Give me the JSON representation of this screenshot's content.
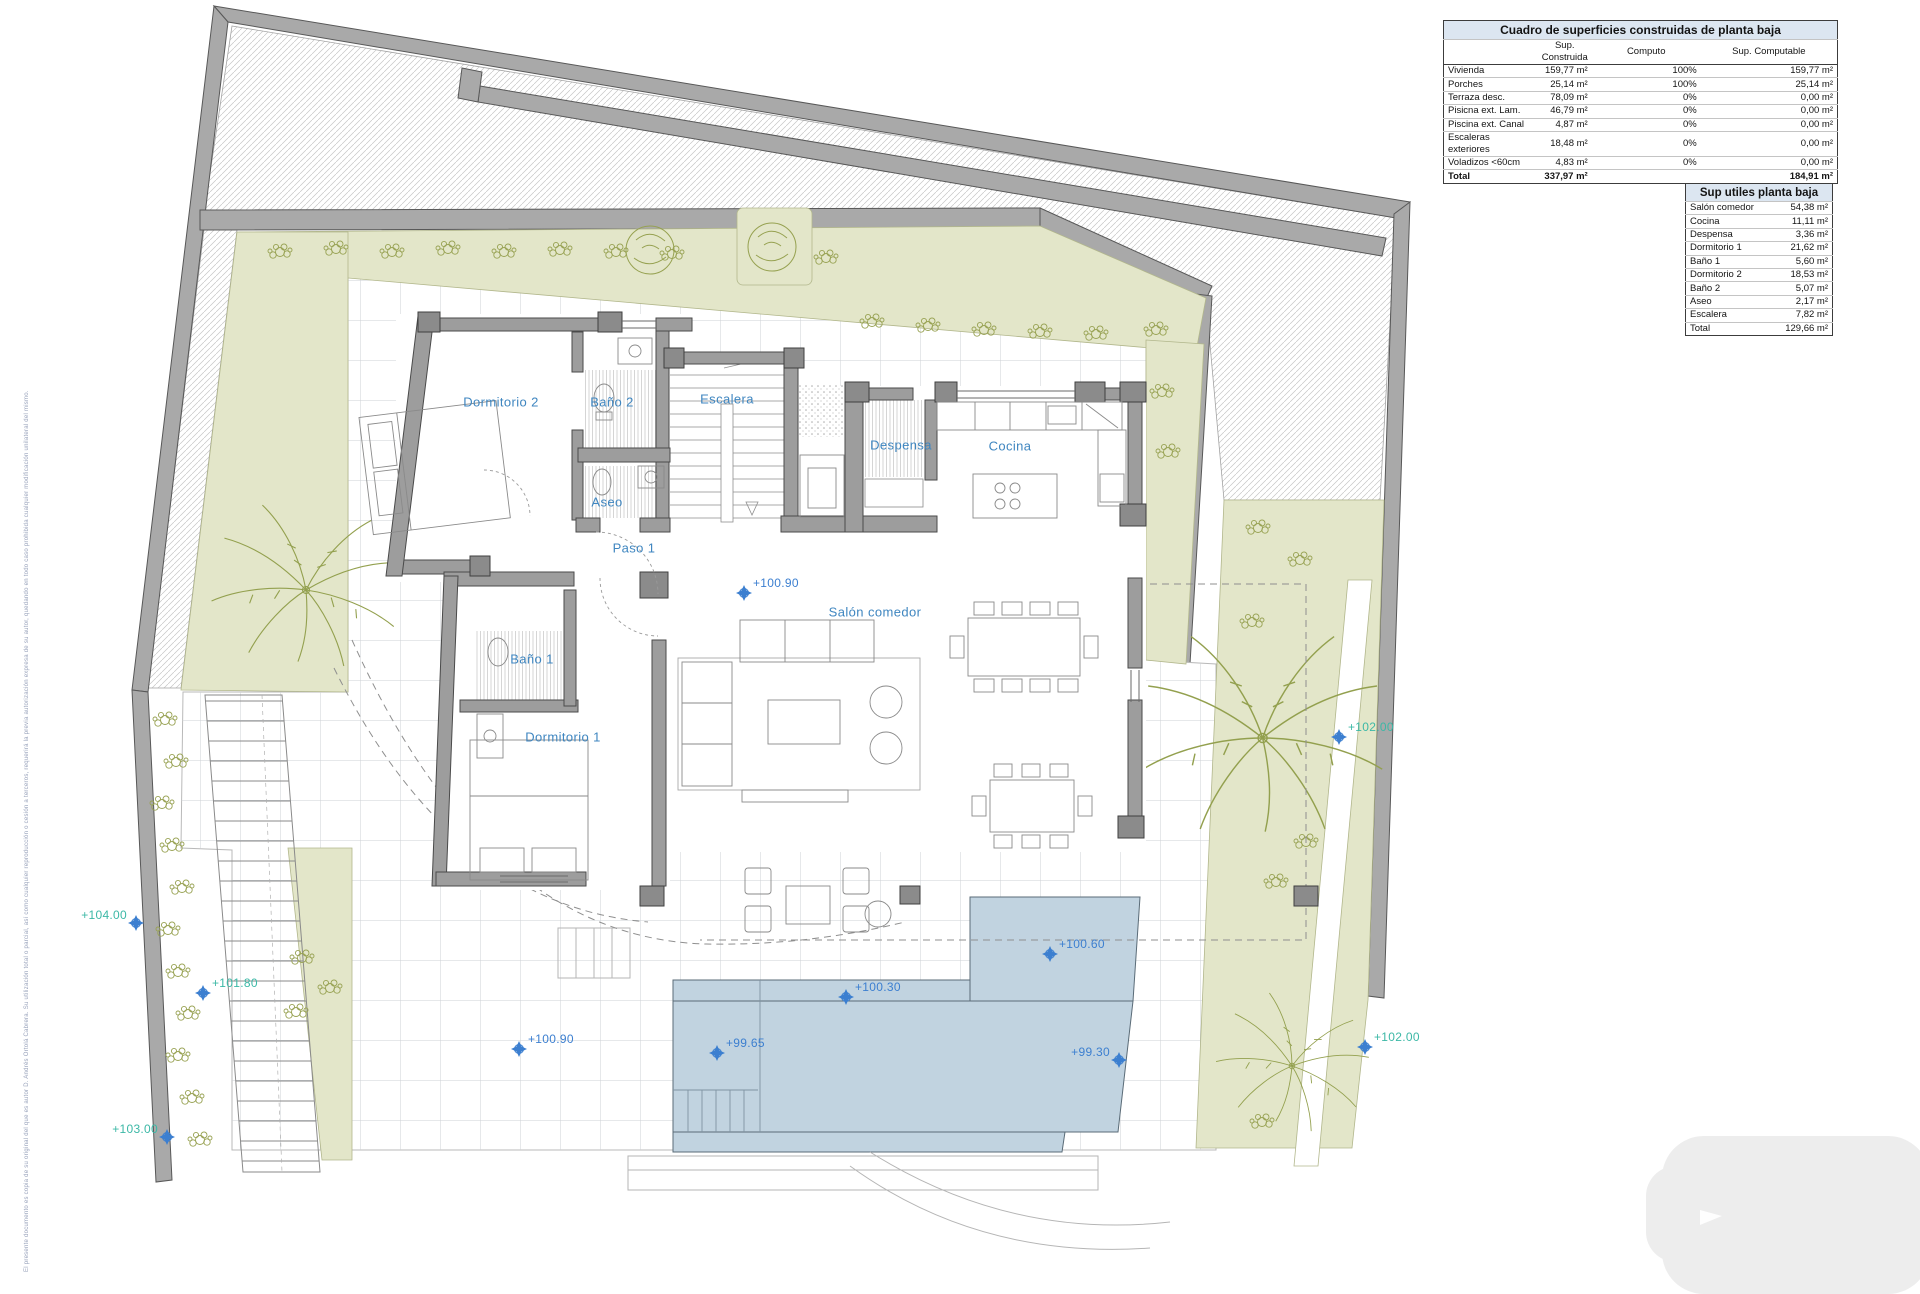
{
  "tables": {
    "constructed": {
      "title": "Cuadro de superficies construidas de planta baja",
      "col_headers": [
        "",
        "Sup. Construida",
        "Computo",
        "Sup. Computable"
      ],
      "rows": [
        {
          "label": "Vivienda",
          "sup_construida": "159,77 m²",
          "computo": "100%",
          "sup_computable": "159,77 m²"
        },
        {
          "label": "Porches",
          "sup_construida": "25,14 m²",
          "computo": "100%",
          "sup_computable": "25,14 m²"
        },
        {
          "label": "Terraza desc.",
          "sup_construida": "78,09 m²",
          "computo": "0%",
          "sup_computable": "0,00 m²"
        },
        {
          "label": "Pisicna ext. Lam.",
          "sup_construida": "46,79 m²",
          "computo": "0%",
          "sup_computable": "0,00 m²"
        },
        {
          "label": "Piscina ext. Canal",
          "sup_construida": "4,87 m²",
          "computo": "0%",
          "sup_computable": "0,00 m²"
        },
        {
          "label": "Escaleras exteriores",
          "sup_construida": "18,48 m²",
          "computo": "0%",
          "sup_computable": "0,00 m²"
        },
        {
          "label": "Voladizos <60cm",
          "sup_construida": "4,83 m²",
          "computo": "0%",
          "sup_computable": "0,00 m²"
        }
      ],
      "total": {
        "label": "Total",
        "sup_construida": "337,97 m²",
        "computo": "",
        "sup_computable": "184,91 m²"
      }
    },
    "useful": {
      "title": "Sup utiles planta baja",
      "rows": [
        {
          "label": "Salón comedor",
          "value": "54,38 m²"
        },
        {
          "label": "Cocina",
          "value": "11,11 m²"
        },
        {
          "label": "Despensa",
          "value": "3,36 m²"
        },
        {
          "label": "Dormitorio 1",
          "value": "21,62 m²"
        },
        {
          "label": "Baño 1",
          "value": "5,60 m²"
        },
        {
          "label": "Dormitorio 2",
          "value": "18,53 m²"
        },
        {
          "label": "Baño 2",
          "value": "5,07 m²"
        },
        {
          "label": "Aseo",
          "value": "2,17 m²"
        },
        {
          "label": "Escalera",
          "value": "7,82 m²"
        }
      ],
      "total": {
        "label": "Total",
        "value": "129,66 m²"
      }
    }
  },
  "plan": {
    "room_labels": [
      {
        "text": "Dormitorio 2"
      },
      {
        "text": "Baño 2"
      },
      {
        "text": "Escalera"
      },
      {
        "text": "Aseo"
      },
      {
        "text": "Paso 1"
      },
      {
        "text": "Despensa"
      },
      {
        "text": "Cocina"
      },
      {
        "text": "Salón comedor"
      },
      {
        "text": "Baño 1"
      },
      {
        "text": "Dormitorio 1"
      }
    ],
    "level_markers": [
      {
        "text": "+104.00"
      },
      {
        "text": "+101.80"
      },
      {
        "text": "+103.00"
      },
      {
        "text": "+102.00"
      },
      {
        "text": "+102.00"
      },
      {
        "text": "+100.90"
      },
      {
        "text": "+100.90"
      },
      {
        "text": "+100.60"
      },
      {
        "text": "+100.30"
      },
      {
        "text": "+99.65"
      },
      {
        "text": "+99.30"
      }
    ],
    "colors": {
      "label_blue": "#3f86c0",
      "marker_teal": "#3cb8a6",
      "marker_blue": "#3c7fd0",
      "pool_fill": "#c1d3e0",
      "garden_fill": "#e3e6c9",
      "wall_gray": "#9d9d9d",
      "table_header_bg": "#dce6f1"
    }
  },
  "footer": {
    "copyright_notice": "El presente documento es copia de su original del que es autor D. Andrés Ortolá Cabrera. Su utilización total o parcial, así como cualquier reproducción o cesión a terceros, requerirá la previa autorización expresa de su autor, quedando en todo caso prohibida cualquier modificación unilateral del mismo."
  }
}
